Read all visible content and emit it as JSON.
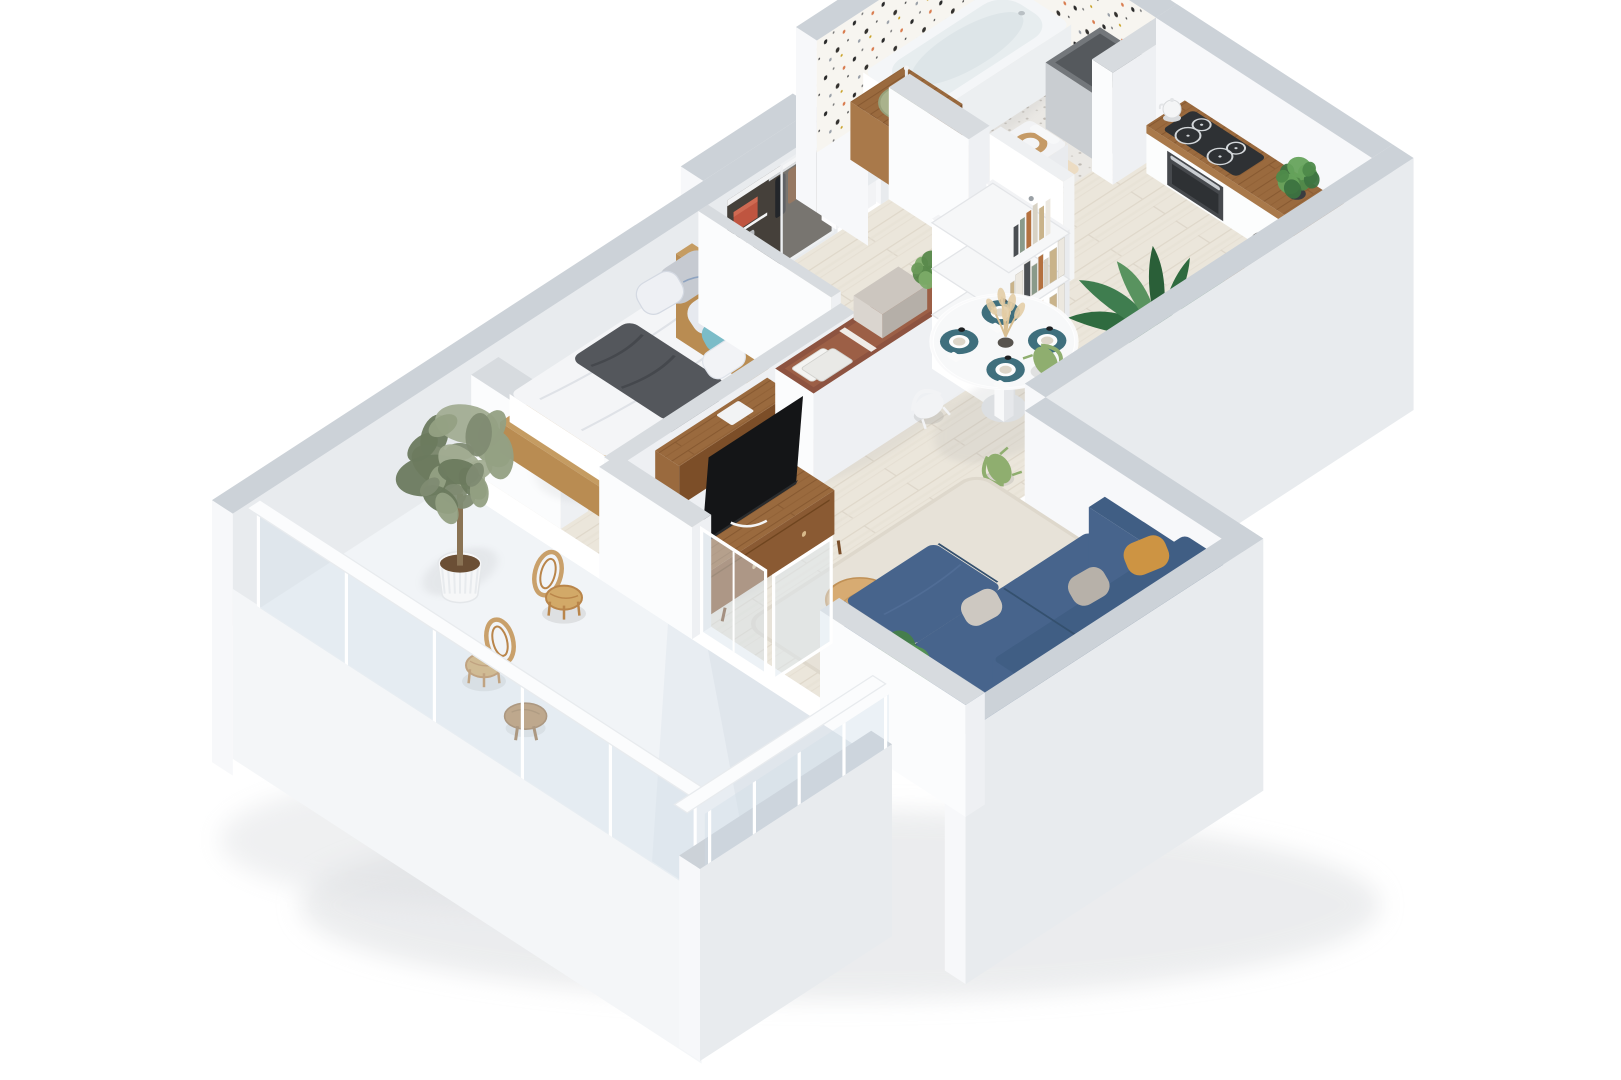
{
  "scene": {
    "type": "isometric-3d-floor-plan-render",
    "description": "Top-down isometric 3D render of a one-bedroom apartment with balcony, white walls with grey cut tops, whitewashed wood flooring",
    "background": "#ffffff",
    "visible_text": "none"
  },
  "palette": {
    "wall_top": "#ccd2d8",
    "wall_bright": "#f7f8fa",
    "wall_shade": "#e8ebee",
    "floor_wood": "#e9e3d7",
    "floor_balcony": "#e8edf2",
    "bathroom_floor": "#eae8e4",
    "terrazzo_base": "#f7f5f0",
    "counter_wood": "#9a6a3e",
    "tv_console_wood": "#8a5a33",
    "sofa_navy": "#3f5c7d",
    "pillow_mustard": "#cd9443",
    "pillow_teal": "#7bbcc8",
    "chair_sage": "#8fae6f",
    "placemat_teal": "#3f6f7d",
    "terracotta_shelf": "#8d5340",
    "red_storage_box": "#bf5540",
    "vanity_bowl_sage": "#a9b28c",
    "rattan": "#c9a06a",
    "plant_green": "#3f7d4f",
    "olive_green": "#7f8b72",
    "steel": "#a7adb2",
    "tv_black": "#141517"
  },
  "rooms": [
    {
      "id": "bedroom",
      "label": "Bedroom",
      "furniture": [
        "double bed with light wood frame",
        "white duvet",
        "grey pillows",
        "blue striped pillows",
        "teal accent pillow",
        "dark grey throw blanket",
        "wooden headboard",
        "white closet block"
      ]
    },
    {
      "id": "hallway",
      "label": "Hall / Entry",
      "furniture": [
        "built-in wardrobe with hanging clothes",
        "wardrobe shelf with red storage box",
        "folded grey towels",
        "sliding glass wardrobe panel",
        "white entry door"
      ]
    },
    {
      "id": "bathroom",
      "label": "Bathroom",
      "furniture": [
        "white bathtub",
        "terrazzo feature walls",
        "wooden vanity cube",
        "sage green vessel sink",
        "toilet with wooden seat",
        "beige bath mat",
        "grey utility shaft"
      ]
    },
    {
      "id": "kitchen",
      "label": "Kitchen",
      "furniture": [
        "L-shaped wooden countertop",
        "black induction cooktop",
        "built-in oven",
        "white kettle",
        "stainless steel sink with faucet",
        "herb plant",
        "fruit tray",
        "white shelf with glass bottles",
        "tall palm plant"
      ]
    },
    {
      "id": "dining",
      "label": "Dining area",
      "furniture": [
        "round white pedestal table",
        "four teal placemats with plates and cups",
        "pampas grass in dark vase",
        "two sage green chairs",
        "two white chairs"
      ]
    },
    {
      "id": "living",
      "label": "Living room",
      "furniture": [
        "navy L-shaped sofa",
        "mustard cushion",
        "grey cushions",
        "beige rug",
        "round wooden coffee table",
        "wooden TV console",
        "black flat-screen TV",
        "terracotta open storage divider with boxes",
        "white ladder bookshelf with books",
        "wooden desk",
        "grey chair",
        "fiddle-leaf fig plant",
        "hanging ivy"
      ]
    },
    {
      "id": "balcony",
      "label": "Balcony / Terrace",
      "furniture": [
        "two rattan armchairs",
        "round wooden side table",
        "olive tree in white ribbed planter",
        "glass balustrade with white rails"
      ]
    }
  ]
}
